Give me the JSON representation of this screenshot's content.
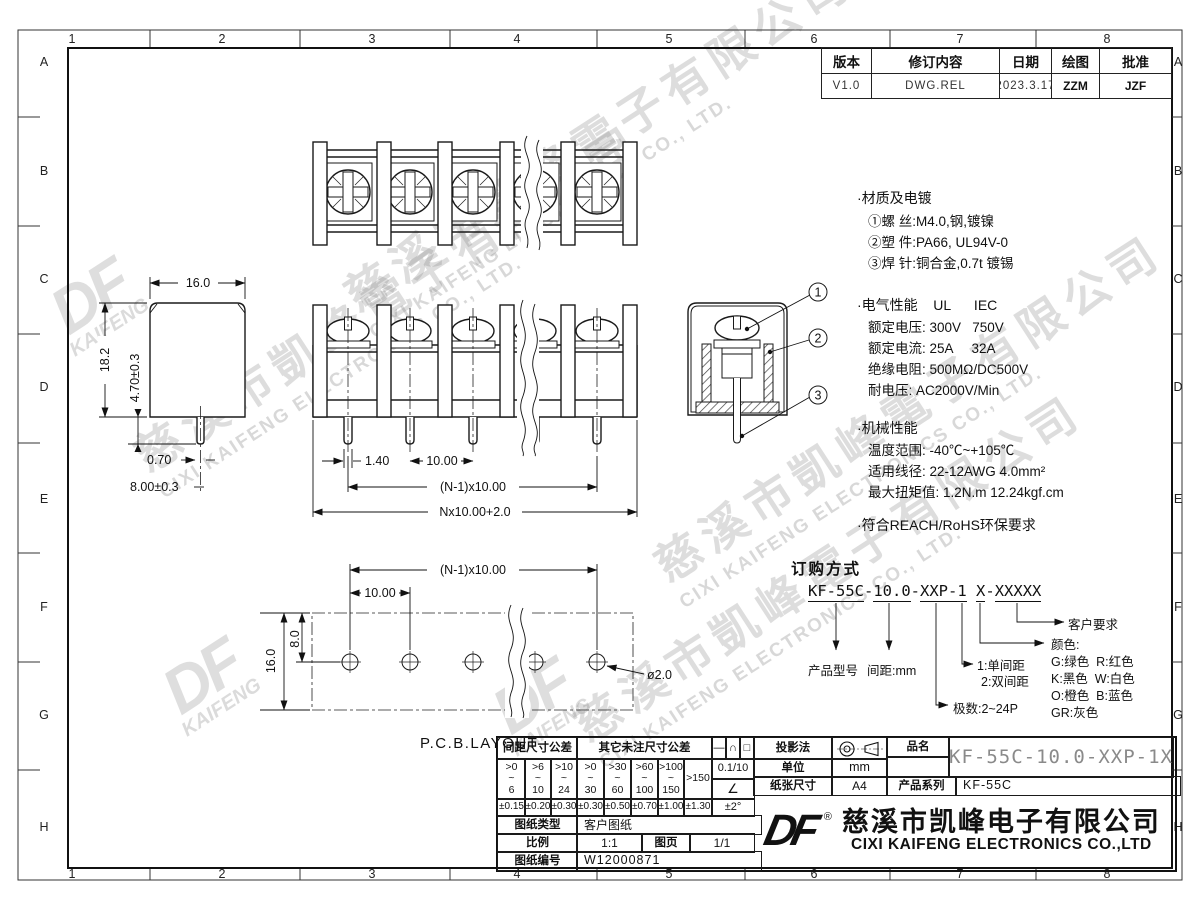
{
  "sheet": {
    "grid_cols": [
      "1",
      "2",
      "3",
      "4",
      "5",
      "6",
      "7",
      "8"
    ],
    "grid_rows": [
      "A",
      "B",
      "C",
      "D",
      "E",
      "F",
      "G",
      "H"
    ]
  },
  "watermark": {
    "cn": "慈溪市凱峰電子有限公司",
    "en": "CIXI KAIFENG ELECTRONICS CO., LTD.",
    "logo": "DF",
    "logo_sub": "KAIFENG"
  },
  "revision": {
    "col_version": "版本",
    "col_content": "修订内容",
    "col_date": "日期",
    "col_draw": "绘图",
    "col_approve": "批准",
    "version": "V1.0",
    "content": "DWG.REL",
    "date": "2023.3.17",
    "draw": "ZZM",
    "approve": "JZF"
  },
  "notes": {
    "material_title": "·材质及电镀",
    "material_1": "①螺 丝:M4.0,钢,镀镍",
    "material_2": "②塑 件:PA66, UL94V-0",
    "material_3": "③焊 针:铜合金,0.7t 镀锡",
    "electrical_title": "·电气性能    UL      IEC",
    "electrical_1": "额定电压: 300V   750V",
    "electrical_2": "额定电流: 25A     32A",
    "electrical_3": "绝缘电阻: 500MΩ/DC500V",
    "electrical_4": "耐电压: AC2000V/Min",
    "mechanical_title": "·机械性能",
    "mechanical_1": "温度范围: -40℃~+105℃",
    "mechanical_2": "适用线径: 22-12AWG 4.0mm²",
    "mechanical_3": "最大扭矩值: 1.2N.m 12.24kgf.cm",
    "compliance": "·符合REACH/RoHS环保要求"
  },
  "ordering": {
    "title": "订购方式",
    "seg1": "KF-55C",
    "sep1": "-",
    "seg2": "10.0",
    "sep2": "-",
    "seg3": "XXP-1",
    "sep3": " ",
    "seg4": "X",
    "sep4": "-",
    "seg5": "XXXXX",
    "label_model": "产品型号",
    "label_pitch": "间距:mm",
    "label_single": "1:单间距",
    "label_double": "2:双间距",
    "label_poles": "极数:2~24P",
    "label_color": "颜色:",
    "color_1": "G:绿色  R:红色",
    "color_2": "K:黑色  W:白色",
    "color_3": "O:橙色  B:蓝色",
    "color_4": "GR:灰色",
    "label_customer": "客户要求"
  },
  "dims": {
    "side_w": "16.0",
    "side_h": "18.2",
    "pin_len": "4.70±0.3",
    "pin_w": "0.70",
    "pin_pos": "8.00±0.3",
    "front_pin": "1.40",
    "front_pitch": "10.00",
    "front_span": "(N-1)x10.00",
    "front_total": "Nx10.00+2.0",
    "pcb_span": "(N-1)x10.00",
    "pcb_pitch": "10.00",
    "pcb_offset": "8.0",
    "pcb_height": "16.0",
    "pcb_hole": "ø2.0",
    "callout_1": "1",
    "callout_2": "2",
    "callout_3": "3"
  },
  "pcb_label": "P.C.B.LAYOUT",
  "title_block": {
    "tol_spacing_header": "间距尺寸公差",
    "tol_other_header": "其它未注尺寸公差",
    "sr_1": ">0\n~\n6",
    "sr_2": ">6\n~\n10",
    "sr_3": ">10\n~\n24",
    "or_1": ">0\n~\n30",
    "or_2": ">30\n~\n60",
    "or_3": ">60\n~\n100",
    "or_4": ">100\n~\n150",
    "or_5": ">150",
    "st_1": "±0.15",
    "st_2": "±0.20",
    "st_3": "±0.30",
    "ot_1": "±0.30",
    "ot_2": "±0.50",
    "ot_3": "±0.70",
    "ot_4": "±1.00",
    "ot_5": "±1.30",
    "sym_line": "—",
    "sym_arc": "∩",
    "sym_square": "□",
    "sym_val1": "0.1/10",
    "sym_angle": "∠",
    "sym_val2": "±2°",
    "projection_label": "投影法",
    "unit_label": "单位",
    "unit_value": "mm",
    "paper_label": "纸张尺寸",
    "paper_value": "A4",
    "part_label": "品名",
    "part_value": "KF-55C-10.0-XXP-1X",
    "series_label": "产品系列",
    "series_value": "KF-55C",
    "type_label": "图纸类型",
    "type_value": "客户图纸",
    "scale_label": "比例",
    "scale_value": "1:1",
    "page_label": "图页",
    "page_value": "1/1",
    "number_label": "图纸编号",
    "number_value": "W12000871",
    "reg": "®",
    "logo": "DF",
    "company_cn": "慈溪市凯峰电子有限公司",
    "company_en": "CIXI KAIFENG ELECTRONICS CO.,LTD"
  }
}
